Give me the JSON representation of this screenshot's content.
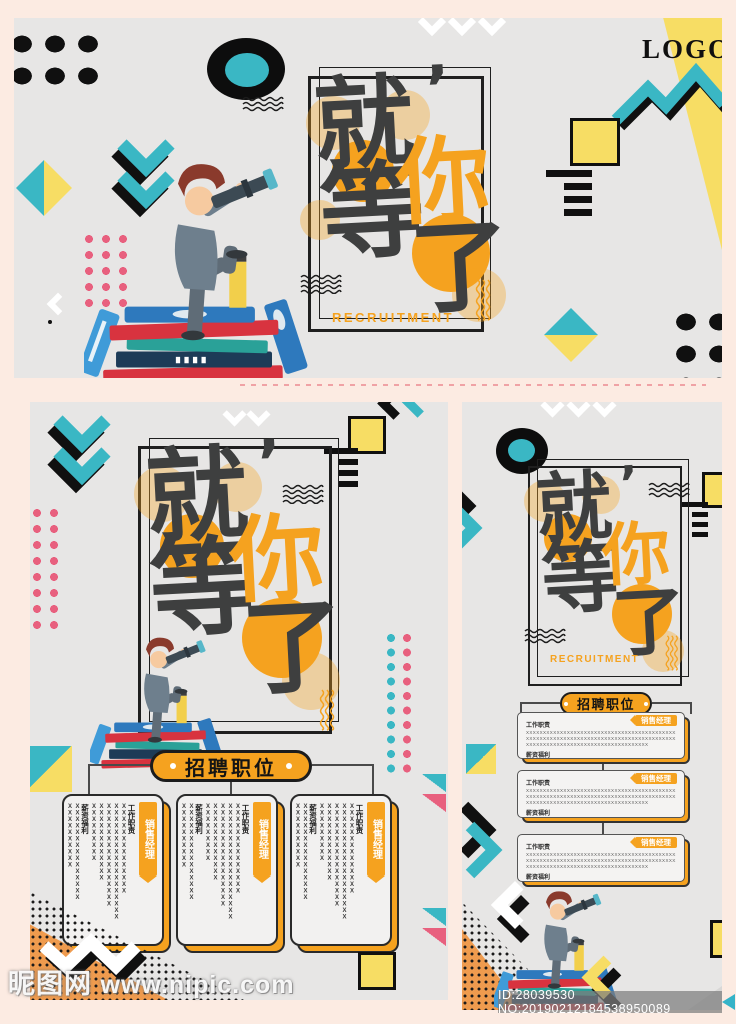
{
  "page": {
    "background": "#fcebe2",
    "watermark_brand": "昵图网",
    "watermark_url": "www.nipic.com",
    "id_label": "ID:28039530 NO:20190212184538950089"
  },
  "colors": {
    "poster_bg": "#e7e6e5",
    "teal": "#3ab7c4",
    "yellow": "#f7dd64",
    "orange": "#f5a21f",
    "pink": "#e8607e",
    "ink": "#1f1f1f",
    "calligraphy": "#3e3f3f"
  },
  "brand": {
    "logo": "LOGO"
  },
  "headline": {
    "char_1": "就",
    "comma": "’",
    "char_2": "等",
    "char_3": "你",
    "char_4": "了",
    "subtitle": "RECRUITMENT"
  },
  "jobs": {
    "section_title": "招聘职位",
    "position_title": "销售经理",
    "duties_label": "工作职责",
    "benefits_label": "薪资福利",
    "v_duty_cols": [
      "XXXXXXXXXXXXXX",
      "XXXXXXXXXXXXXXXXXX",
      "XXXXXXXXXXXXXXXX",
      "XXXXXXXXXXXX",
      "XXXXXXXXX"
    ],
    "v_benefit_cols": [
      "XXXXXXXXXXXXXXX",
      "XXXXXXXXXX"
    ],
    "h_duty_lines": [
      "XXXXXXXXXXXXXXXXXXXXXXXXXXXXXXXXXXXXXXXXXXXXXXXXXXXXXXXXXXXXXXXXXX",
      "XXXXXXXXXXXXXXXXXXXXXXXXXXXXXXXXXXXXXXXXXXXXXXXXXXXXXXXXXXXX",
      "XXXXXXXXXXXXXXXXXXXXXXXXXXXXXXXXXXXX"
    ],
    "h_benefit_lines": [
      "XXXXXXXXXXXXXXXXXX"
    ]
  }
}
